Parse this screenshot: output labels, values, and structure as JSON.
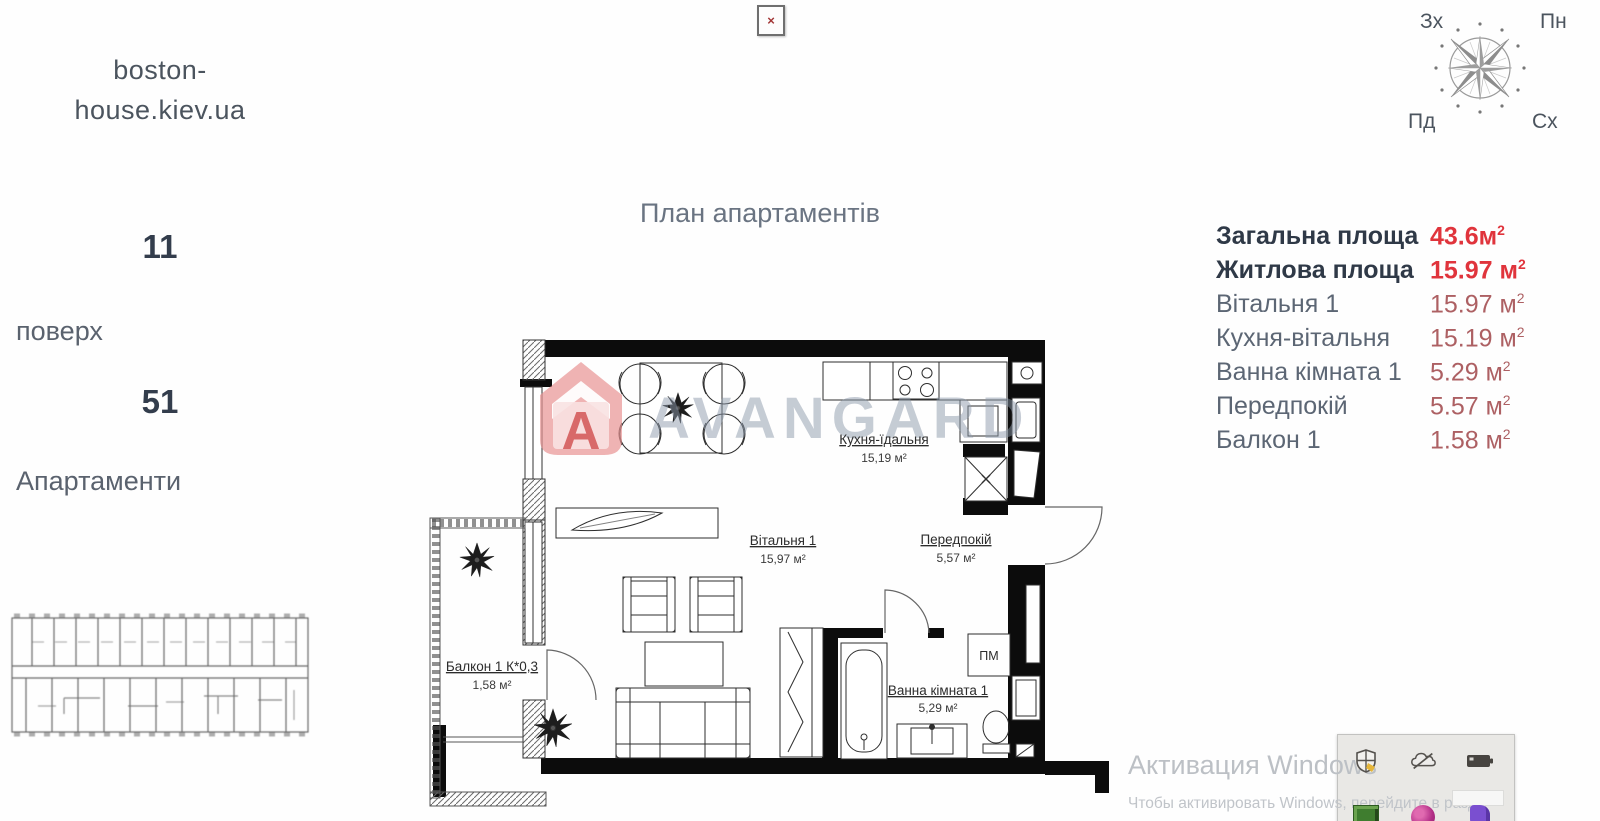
{
  "site": {
    "line1": "boston-",
    "line2": "house.kiev.ua"
  },
  "broken_icon": {
    "glyph": "×"
  },
  "left_panel": {
    "floor_number": "11",
    "floor_label": "поверх",
    "apartment_number": "51",
    "apartment_label": "Апартаменти"
  },
  "title": "План апартаментів",
  "compass": {
    "west": "Зх",
    "north": "Пн",
    "south": "Пд",
    "east": "Сх"
  },
  "table": {
    "rows": [
      {
        "label": "Загальна площа",
        "value": "43.6м",
        "sup": "2"
      },
      {
        "label": "Житлова площа",
        "value": "15.97 м",
        "sup": "2"
      },
      {
        "label": "Вітальня 1",
        "value": "15.97 м",
        "sup": "2"
      },
      {
        "label": "Кухня-вітальня",
        "value": "15.19 м",
        "sup": "2"
      },
      {
        "label": "Ванна кімната 1",
        "value": "5.29 м",
        "sup": "2"
      },
      {
        "label": "Передпокій",
        "value": "5.57 м",
        "sup": "2"
      },
      {
        "label": "Балкон 1",
        "value": "1.58 м",
        "sup": "2"
      }
    ]
  },
  "plan": {
    "kitchen": {
      "name": "Кухня-їдальня",
      "area": "15,19 м²"
    },
    "living": {
      "name": "Вітальня 1",
      "area": "15,97 м²"
    },
    "hall": {
      "name": "Передпокій",
      "area": "5,57 м²"
    },
    "bath": {
      "name": "Ванна кімната 1",
      "area": "5,29 м²"
    },
    "balcony": {
      "name": "Балкон 1 К*0,3",
      "area": "1,58 м²"
    },
    "pm": "ПМ"
  },
  "watermark": {
    "brand": "AVANGARD",
    "letter": "A"
  },
  "activation": {
    "title": "Активация Windows",
    "subtitle": "Чтобы активировать Windows, перейдите в разде"
  },
  "colors": {
    "accent_red": "#e0343c",
    "muted_value": "#ad6063",
    "dark_navy": "#2f3947",
    "gray_text": "#5a626e",
    "watermark_gray": "#8d99ac",
    "watermark_red": "#e89191"
  }
}
